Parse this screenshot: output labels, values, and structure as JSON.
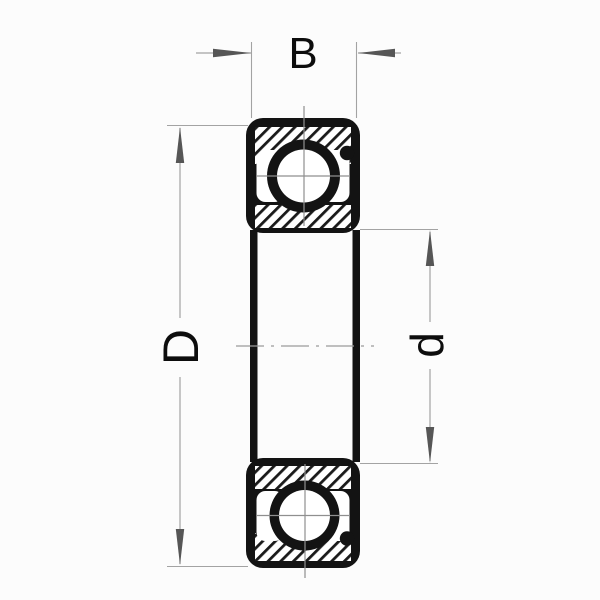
{
  "diagram": {
    "kind": "deep-groove-ball-bearing-cross-section",
    "dimension_labels": {
      "width": "B",
      "outer_diameter": "D",
      "bore_diameter": "d"
    },
    "colors": {
      "background": "#fcfcfc",
      "outline": "#131313",
      "hatch_line": "#1a1a1a",
      "dimension_line": "#a3a3a3",
      "arrow": "#565656",
      "centerline": "#9a9a9a",
      "label_text": "#0d0d0d"
    }
  }
}
